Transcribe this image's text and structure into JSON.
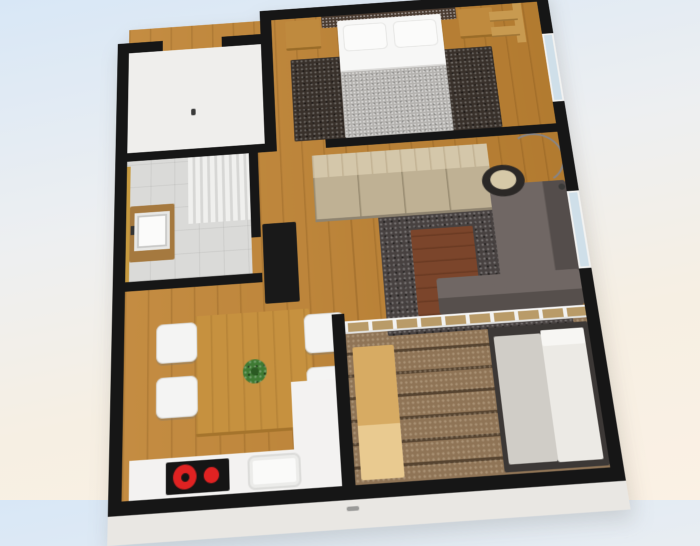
{
  "meta": {
    "description": "3D rendered top-down perspective floor plan of a one-bedroom apartment, no visible text labels",
    "view": "3d-floorplan-render"
  },
  "palette": {
    "bg_top": "#d8e7f6",
    "bg_mid": "#edeff1",
    "bg_cream": "#f6efe3",
    "bg_bottom": "#fbf1e4",
    "wall": "#161616",
    "wood": "#c08434",
    "entry_floor": "#efeeec",
    "bath_floor": "#dadad8",
    "deck": "#8f7456",
    "bed_rug": "#38302a",
    "living_rug": "#474140",
    "headboard": "#4a3b30",
    "bed": "#f7f7f6",
    "pillow": "#fbfbfa",
    "duvet": "#b4b2af",
    "nightstand": "#bf8a3e",
    "shelf": "#c89a50",
    "floor_handle": "#3a3a3a",
    "towel_rail_gold": "#c79a3f",
    "vanity": "#a5793f",
    "basin": "#fbfbfa",
    "tap": "#333333",
    "tv_cabinet": "#191919",
    "basket": "#8a6a3c",
    "wardrobe_top": "#d4c7aa",
    "wardrobe_front": "#bfb194",
    "coffee_table": "#7b452b",
    "sofa": "#675e5b",
    "lamp_shade": "#2b2826",
    "lamp_inner": "#d6c9a8",
    "lamp_base": "#3a3a38",
    "dining_table": "#c6913f",
    "plant": "#3e7a33",
    "plant_dark": "#2a5a22",
    "chair": "#f4f4f3",
    "counter": "#f3f2f1",
    "cooktop": "#151515",
    "burner_red": "#e02222",
    "sink": "#fafaf9",
    "bench": "#d7ab63",
    "daybed_frame": "#3c3836",
    "daybed_seat": "#d0cdc7",
    "daybed_mattress": "#eceae5",
    "mattress_pillow": "#f7f6f3",
    "window_glass": "#cfdfe9",
    "ext_face": "#e9e7e3",
    "ext_handle": "#9a9a98"
  },
  "rooms": [
    {
      "id": "entry-hall",
      "features": [
        "door-opening-top-wall",
        "white-floor"
      ]
    },
    {
      "id": "bedroom",
      "features": [
        "double-bed",
        "dark-headboard",
        "pillows-x2",
        "gray-duvet",
        "nightstand-left",
        "nightstand-right",
        "dark-bedside-rug",
        "wall-shelf-unit",
        "window-right-wall"
      ]
    },
    {
      "id": "bathroom",
      "features": [
        "vanity-sink",
        "shower-curtain",
        "towel-rail",
        "tiled-floor"
      ]
    },
    {
      "id": "hallway",
      "features": [
        "tv-cabinet",
        "storage-basket",
        "wardrobe"
      ]
    },
    {
      "id": "living-room",
      "features": [
        "corner-sofa",
        "coffee-table",
        "dark-area-rug",
        "arc-floor-lamp",
        "window-right-wall",
        "glass-partition-to-balcony"
      ]
    },
    {
      "id": "kitchen-dining",
      "features": [
        "dining-table",
        "potted-plant",
        "chairs-x4",
        "l-shaped-counter",
        "cooktop-2-burners",
        "kitchen-sink"
      ]
    },
    {
      "id": "balcony",
      "features": [
        "wood-deck",
        "bench-table",
        "daybed"
      ]
    }
  ],
  "counts": {
    "rooms": 7,
    "dining_chairs": 4,
    "bed_pillows": 2,
    "cooktop_burners": 2,
    "windows": 2
  }
}
